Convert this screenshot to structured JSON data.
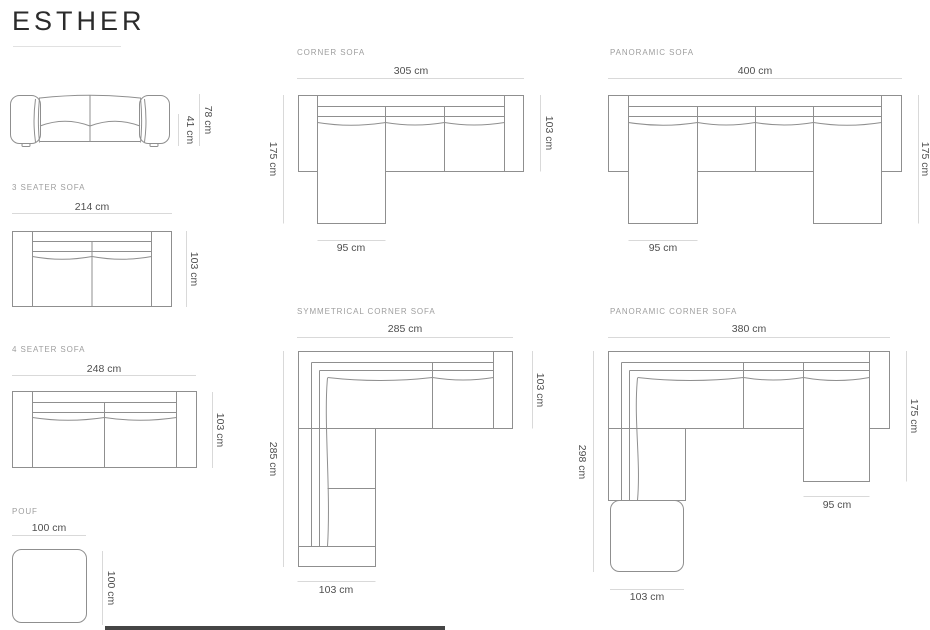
{
  "page": {
    "title": "ESTHER"
  },
  "sections": {
    "front_view": {
      "total_height": "78 cm",
      "seat_height": "41 cm"
    },
    "three_seater": {
      "label": "3 SEATER SOFA",
      "width": "214 cm",
      "depth": "103 cm"
    },
    "four_seater": {
      "label": "4 SEATER SOFA",
      "width": "248 cm",
      "depth": "103 cm"
    },
    "pouf": {
      "label": "POUF",
      "width": "100 cm",
      "depth": "100 cm"
    },
    "corner": {
      "label": "CORNER SOFA",
      "width": "305 cm",
      "side_depth": "175 cm",
      "back_depth": "103 cm",
      "chaise_width": "95 cm"
    },
    "panoramic": {
      "label": "PANORAMIC SOFA",
      "width": "400 cm",
      "side_depth": "175 cm",
      "chaise_width": "95 cm"
    },
    "symmetrical_corner": {
      "label": "SYMMETRICAL CORNER SOFA",
      "width": "285 cm",
      "back_depth": "103 cm",
      "left_length": "285 cm",
      "wing_width": "103 cm"
    },
    "panoramic_corner": {
      "label": "PANORAMIC CORNER SOFA",
      "width": "380 cm",
      "side_depth": "175 cm",
      "left_length": "298 cm",
      "chaise_width": "95 cm",
      "wing_width": "103 cm"
    }
  },
  "colors": {
    "furniture_line": "#8f8f8f",
    "dimension_line": "#d9d9d9",
    "dimension_text": "#4f4f4f",
    "section_label_text": "#9e9e9e",
    "title_text": "#2b2b2b"
  }
}
